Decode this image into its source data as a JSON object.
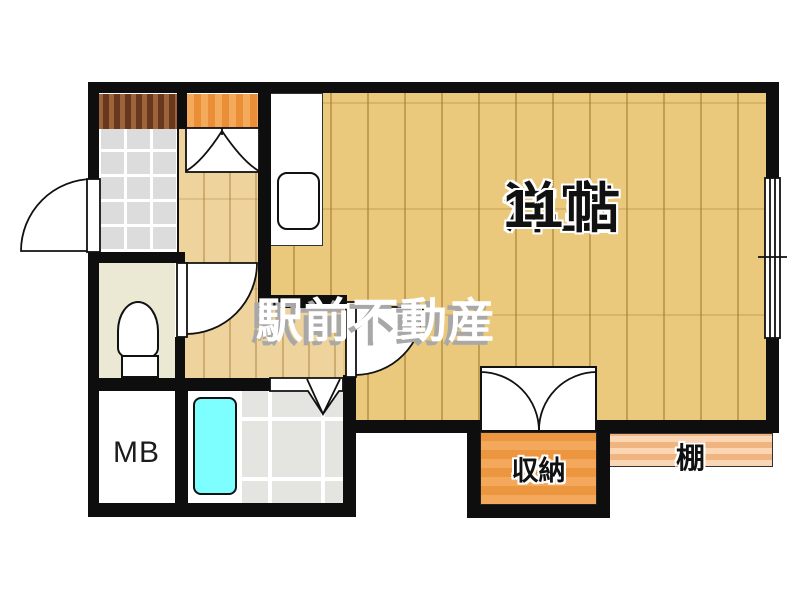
{
  "floorplan": {
    "watermark": "駅前不動産",
    "rooms": {
      "main_room": {
        "label_line1": "洋室",
        "label_line2": "11帖"
      },
      "closet": {
        "label": "収納"
      },
      "shelf": {
        "label": "棚"
      },
      "meter_box": {
        "label": "MB"
      }
    },
    "colors": {
      "wall": "#0e0e0e",
      "wood_floor": "#eac87c",
      "hallway_floor": "#eed49c",
      "entrance_tile": "#dcdcdc",
      "shoe_cabinet": "#7c4526",
      "cabinet": "#f0953d",
      "toilet_floor": "#ebe9d4",
      "bathtub": "#7dffff",
      "bath_tile": "#e4e4e1",
      "closet": "#f09a45",
      "shelf": "#f6c193",
      "watermark_text": "#ffffff",
      "watermark_shadow": "#a8a8a8"
    }
  }
}
